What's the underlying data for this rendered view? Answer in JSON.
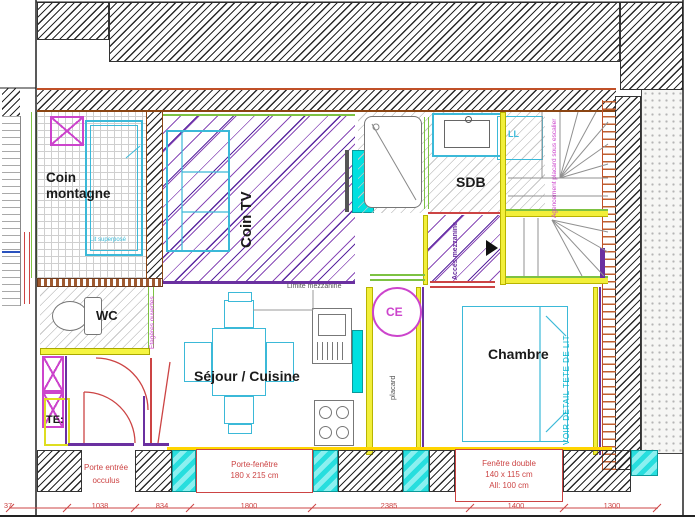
{
  "colors": {
    "wall_line": "#b0552a",
    "cyan_fill": "#00e0e0",
    "furniture_cyan": "#3bb9d8",
    "magenta": "#cc44cc",
    "purple": "#6a30a0",
    "annotation_red": "#cc4444",
    "yellow": "#f2ef3a",
    "green": "#7dc242"
  },
  "rooms": {
    "coin_montagne": {
      "label": "Coin montagne",
      "bed_note": "Lit superposé"
    },
    "coin_tv": {
      "label": "Coin TV"
    },
    "sdb": {
      "label": "SDB",
      "washer_label": "LL"
    },
    "stairs": {
      "note": "Agencement placard sous escalier"
    },
    "mezzanine": {
      "access_label": "Accès mezzanine",
      "limit_label": "Limite mezzanine"
    },
    "wc": {
      "label": "WC",
      "shelves_note": "Etagères ouvertes"
    },
    "sejour": {
      "label": "Séjour / Cuisine"
    },
    "placard": {
      "label": "placard",
      "water_heater_label": "CE"
    },
    "chambre": {
      "label": "Chambre",
      "headboard_note": "VOIR DETAIL TETE DE LIT"
    },
    "entry": {
      "board_label": "TE:"
    }
  },
  "openings": {
    "entry_door": {
      "line1": "Porte entrée",
      "line2": "occulus"
    },
    "french_window": {
      "line1": "Porte-fenêtre",
      "line2": "180 x 215 cm"
    },
    "double_window": {
      "line1": "Fenêtre double",
      "line2": "140 x 115 cm",
      "line3": "All: 100 cm"
    }
  },
  "dimensions": {
    "values": [
      "37",
      "1038",
      "834",
      "1800",
      "2385",
      "1400",
      "1300"
    ]
  }
}
